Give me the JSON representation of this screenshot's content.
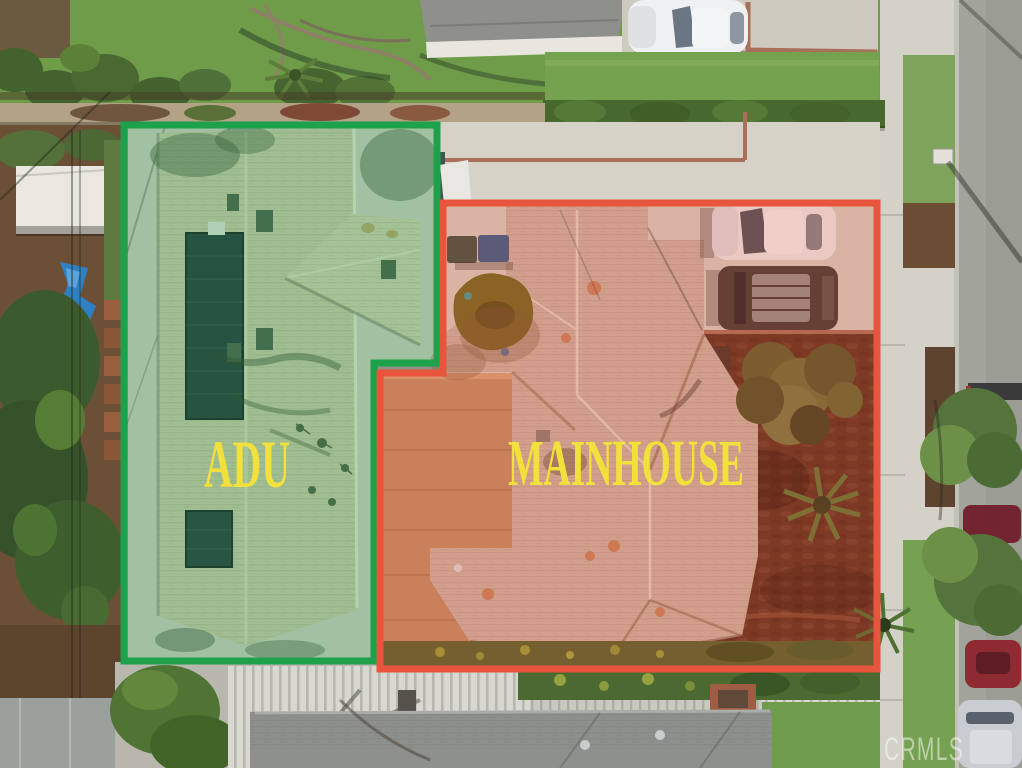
{
  "annotations": {
    "adu": {
      "label": "ADU",
      "outline_color": "#1da14b",
      "fill_tint": "rgba(60,170,90,0.30)",
      "label_color": "#f2e03c"
    },
    "mainhouse": {
      "label": "MAINHOUSE",
      "outline_color": "#e8553d",
      "fill_tint": "rgba(232,80,50,0.24)",
      "label_color": "#f2e03c"
    }
  },
  "watermark": {
    "text": "CRMLS",
    "color": "#ffffff"
  }
}
